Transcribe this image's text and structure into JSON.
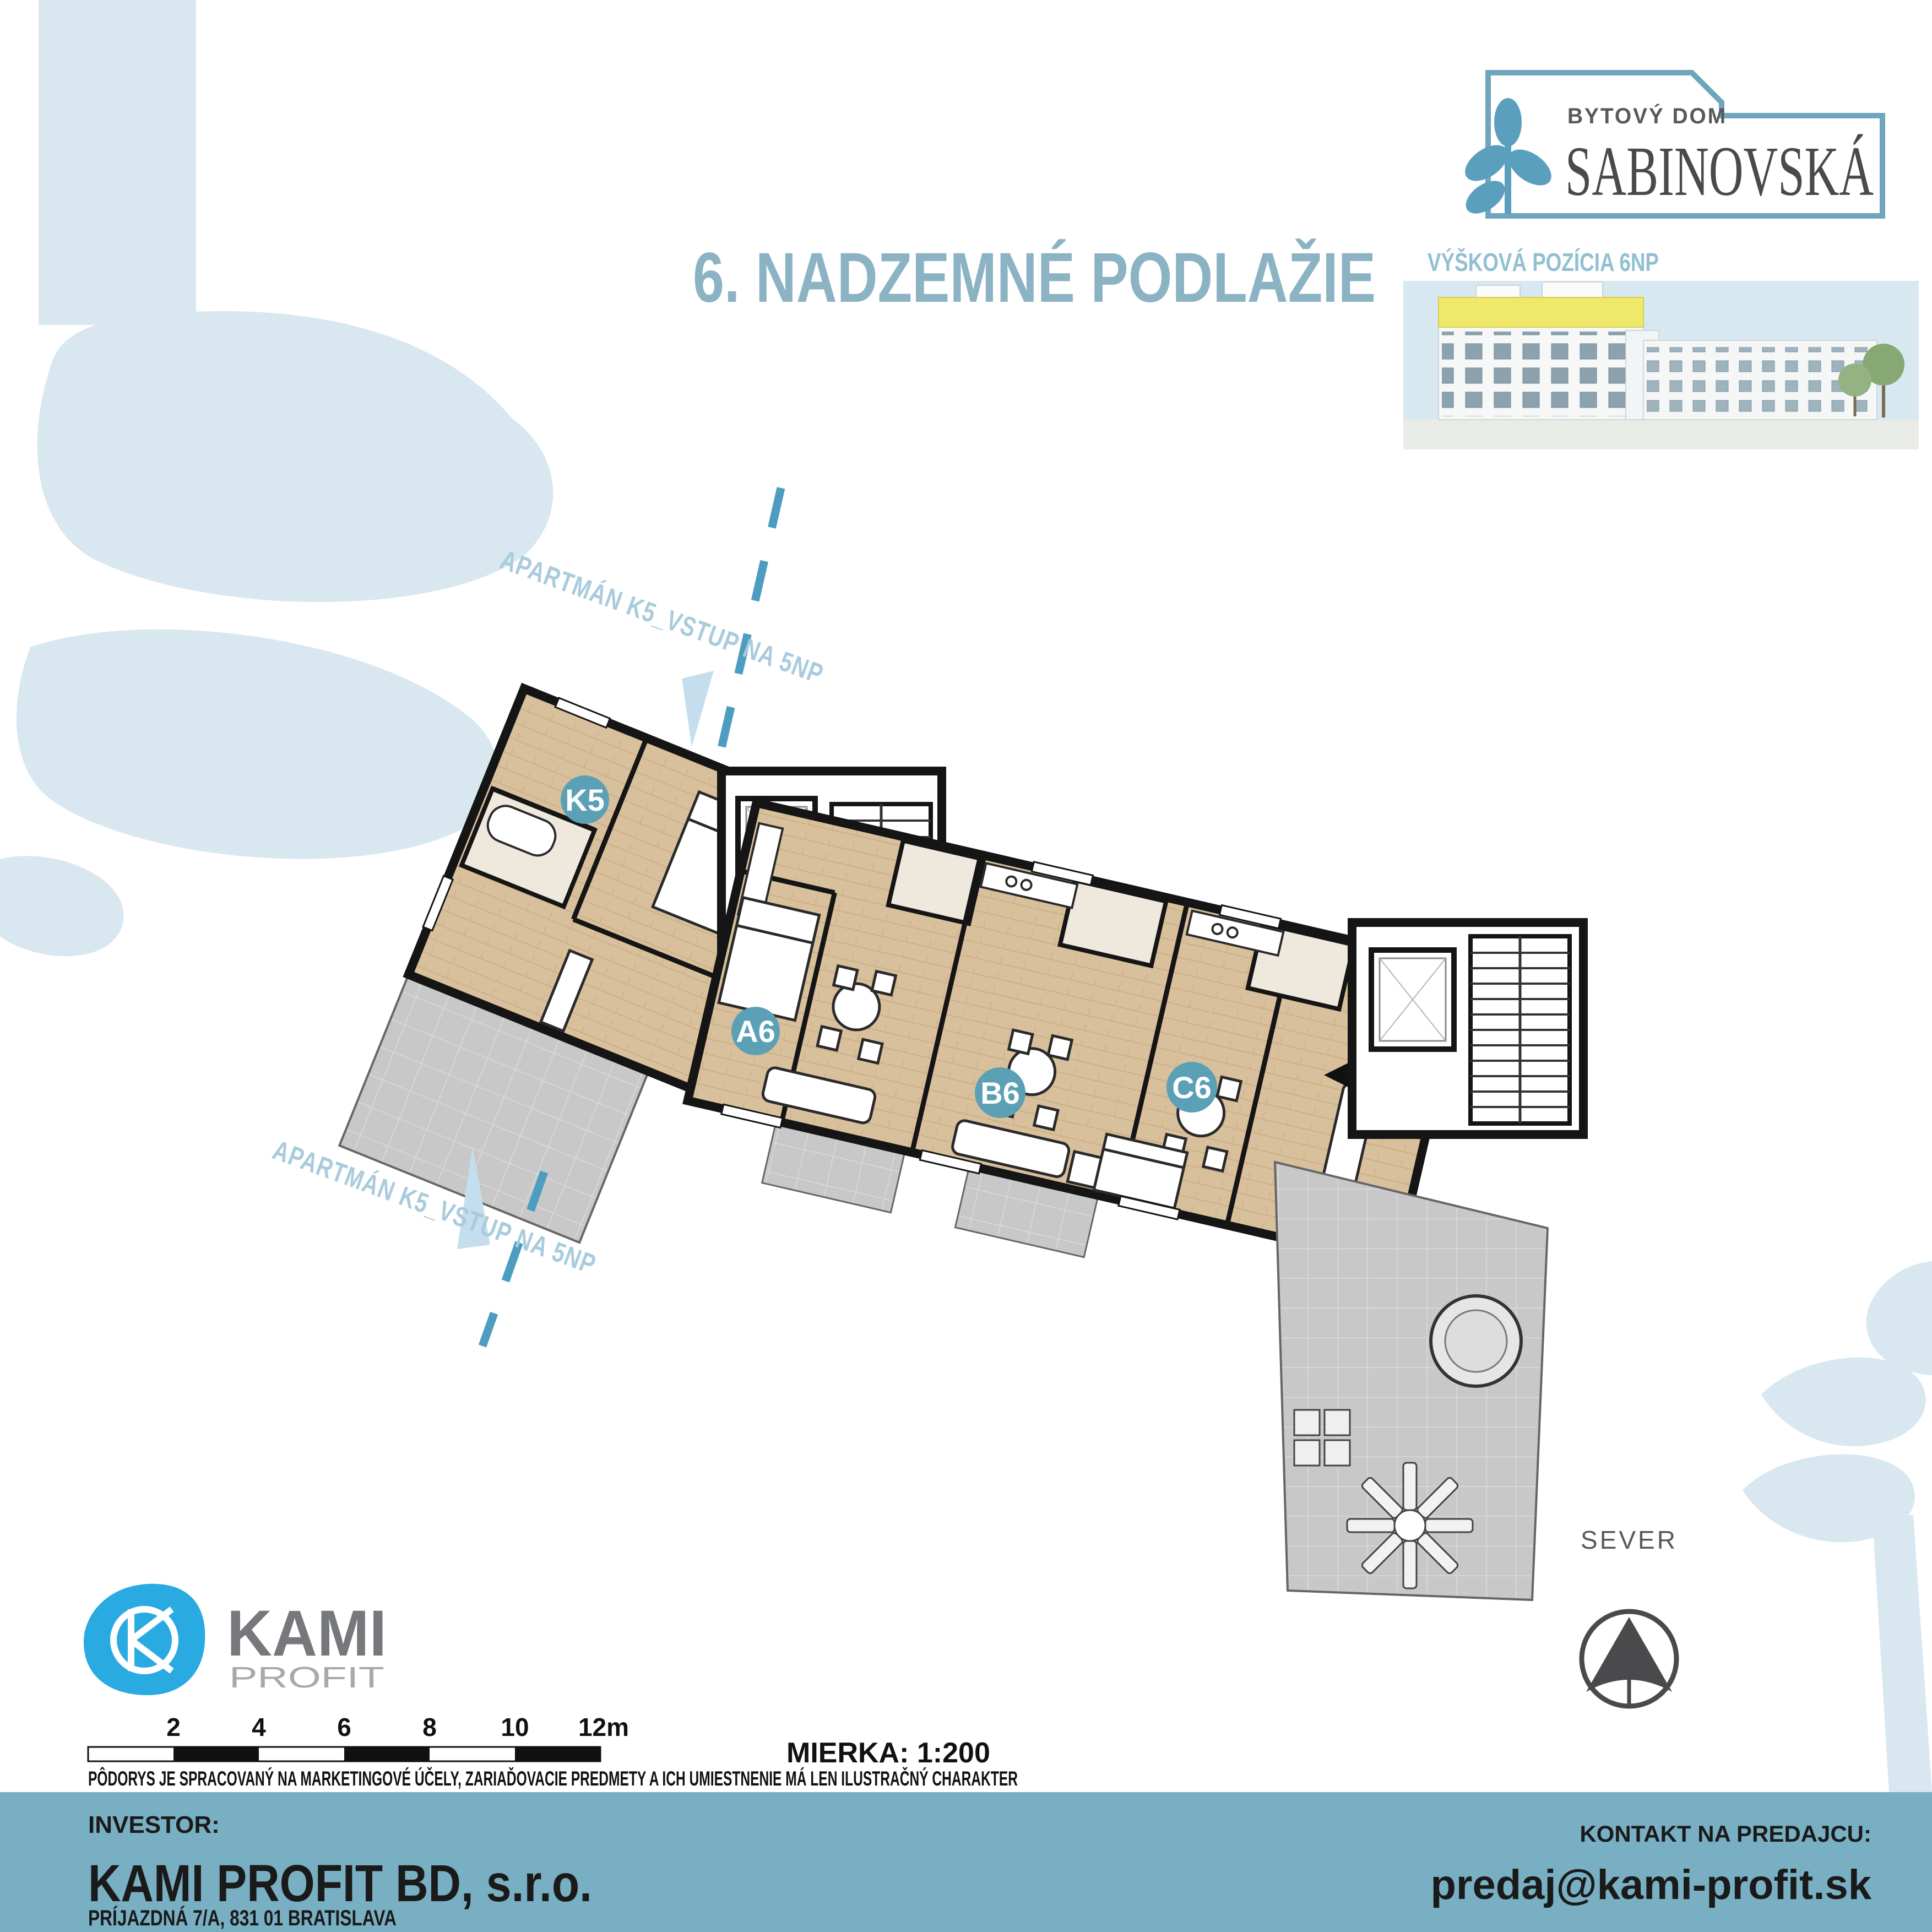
{
  "brand": {
    "logo_top_label": "BYTOVÝ DOM",
    "logo_name": "SABINOVSKÁ"
  },
  "thumbnail": {
    "caption": "VÝŠKOVÁ POZÍCIA 6NP"
  },
  "page": {
    "title": "6. NADZEMNÉ PODLAŽIE"
  },
  "plan": {
    "apartments": [
      {
        "id": "K5"
      },
      {
        "id": "A6"
      },
      {
        "id": "B6"
      },
      {
        "id": "C6"
      }
    ],
    "entry_note_top": "APARTMÁN K5_VSTUP NA 5NP",
    "entry_note_bottom": "APARTMÁN K5_VSTUP NA 5NP"
  },
  "compass": {
    "label": "SEVER"
  },
  "partner": {
    "name": "KAMI",
    "subtitle": "PROFIT"
  },
  "scalebar": {
    "ticks": [
      "2",
      "4",
      "6",
      "8",
      "10",
      "12m"
    ],
    "scale_label": "MIERKA: 1:200"
  },
  "disclaimer": "PÔDORYS JE SPRACOVANÝ NA MARKETINGOVÉ ÚČELY, ZARIAĎOVACIE PREDMETY A ICH UMIESTNENIE MÁ LEN ILUSTRAČNÝ CHARAKTER",
  "footer": {
    "investor_label": "INVESTOR:",
    "investor_name": "KAMI PROFIT BD, s.r.o.",
    "investor_address": "PRÍJAZDNÁ 7/A, 831 01 BRATISLAVA",
    "contact_label": "KONTAKT NA PREDAJCU:",
    "contact_email": "predaj@kami-profit.sk"
  },
  "colors": {
    "accent_teal": "#5CA0B6",
    "title_blue": "#8CB3C3",
    "footer_blue": "#79AFC3",
    "leaf_blue": "#D9E7F1",
    "dash_blue": "#4D9DC0",
    "logo_blue": "#6FA5BD",
    "kami_cyan": "#29ABE2",
    "wood": "#D9C09C",
    "terrace_gray": "#C8C8C8",
    "highlight_yellow": "#F0E86A"
  }
}
